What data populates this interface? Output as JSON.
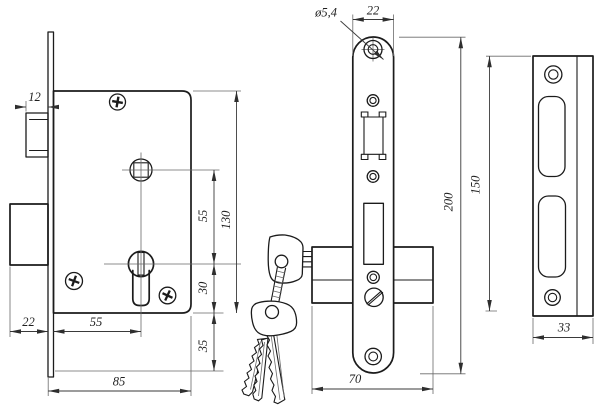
{
  "drawing": {
    "type": "technical-drawing",
    "subject": "mortise lock with cylinder, faceplate and strike plate",
    "colors": {
      "background": "#ffffff",
      "outline": "#1b1b1b",
      "dimension": "#3a3a3a",
      "extension": "#6a6a6a"
    },
    "views": {
      "side": {
        "dims": {
          "latch_width": "12",
          "deadbolt_throw": "22",
          "backset": "55",
          "case_depth": "85",
          "spindle_to_cylinder": "55",
          "case_height": "130",
          "cylinder_to_case_bottom": "30",
          "faceplate_overhang": "35"
        }
      },
      "front": {
        "dims": {
          "screw_hole_diameter": "ø5,4",
          "faceplate_width": "22",
          "faceplate_length": "200",
          "case_width": "70"
        }
      },
      "strike": {
        "dims": {
          "plate_length": "150",
          "plate_width": "33"
        }
      }
    }
  }
}
